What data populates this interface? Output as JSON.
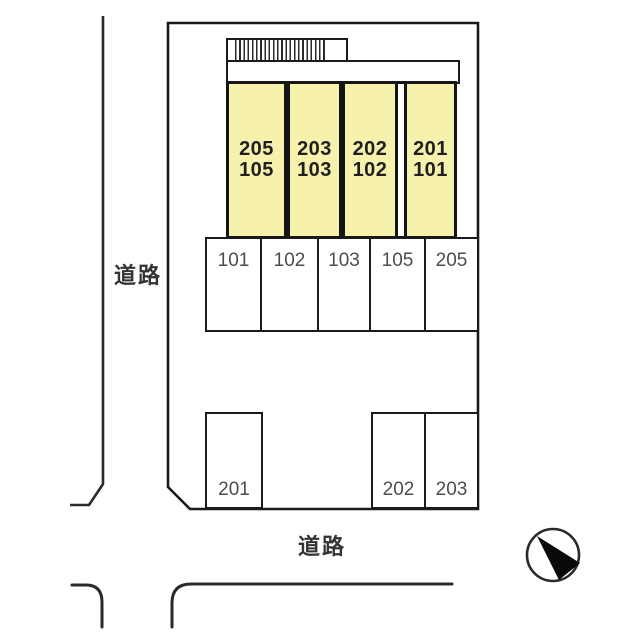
{
  "diagram": {
    "type": "site-plan",
    "roads": {
      "left_label": "道路",
      "bottom_label": "道路"
    },
    "building": {
      "units": [
        {
          "upper": "205",
          "lower": "105"
        },
        {
          "upper": "203",
          "lower": "103"
        },
        {
          "upper": "202",
          "lower": "102"
        },
        {
          "upper": "201",
          "lower": "101"
        }
      ]
    },
    "parking": {
      "front_row": [
        "101",
        "102",
        "103",
        "105",
        "205"
      ],
      "bottom_row": [
        "201",
        "202",
        "203"
      ]
    },
    "icons": {
      "compass": "north-arrow-icon"
    },
    "colors": {
      "unit_fill": "#f6f2ae",
      "outline": "#1a1a1a",
      "unit_text": "#1f1f1f",
      "parking_text": "#4d4d4d",
      "road_text": "#333333",
      "background": "#ffffff"
    }
  }
}
